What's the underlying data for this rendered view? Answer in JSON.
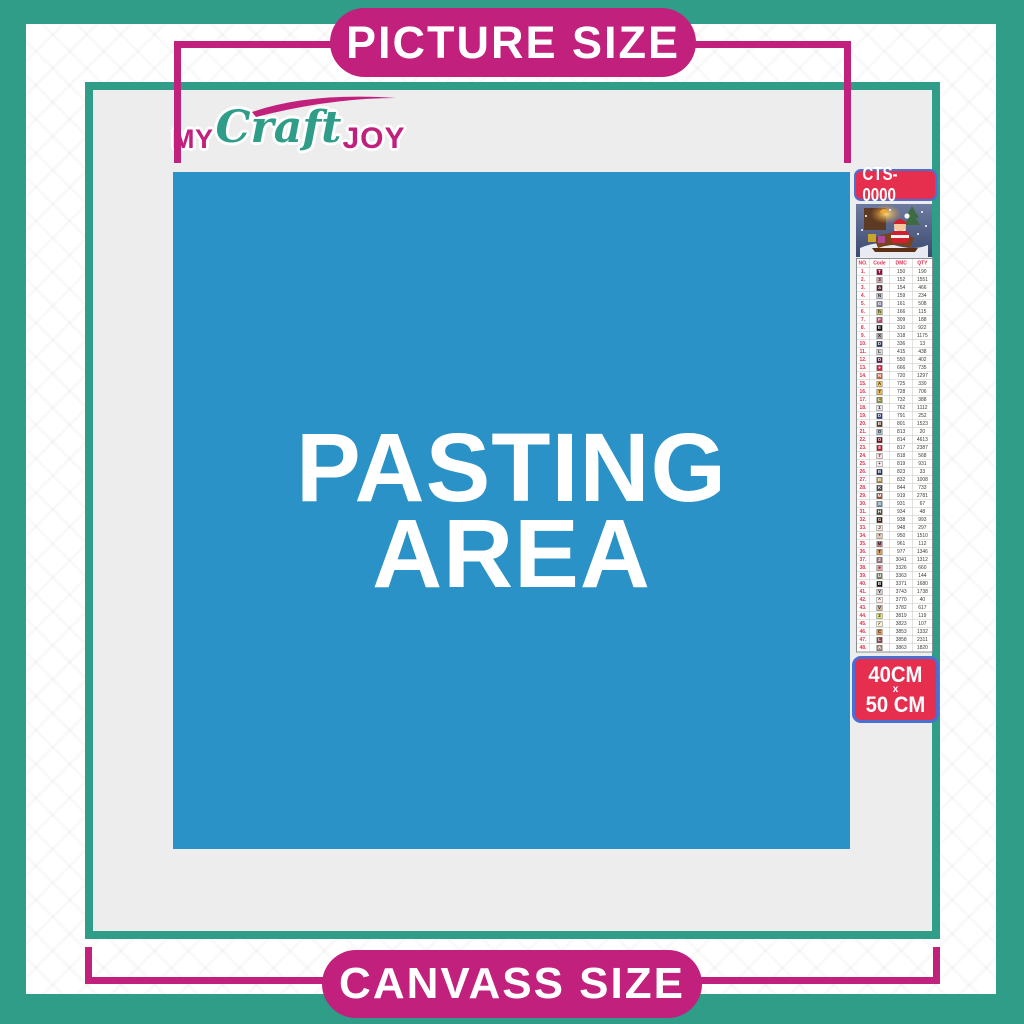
{
  "colors": {
    "teal": "#2f9d88",
    "magenta": "#c1217c",
    "blue": "#2b92c7",
    "red": "#e62e4e",
    "blue_border": "#4a6fd0",
    "interior_gray": "#ededee"
  },
  "banner_top": {
    "label": "PICTURE SIZE"
  },
  "banner_bottom": {
    "label": "CANVASS SIZE"
  },
  "logo": {
    "part1": "MY",
    "part2": "Craft",
    "part3": "JOY"
  },
  "pasting_area": {
    "line1": "PASTING",
    "line2": "AREA"
  },
  "product": {
    "code": "CTS-0000"
  },
  "size_badge": {
    "line1": "40CM",
    "sep": "x",
    "line2": "50 CM"
  },
  "thumbnail": {
    "description": "santa-claus-sleigh-christmas-scene"
  },
  "table": {
    "headers": [
      "NO.",
      "Code",
      "DMC",
      "QTY"
    ],
    "rows": [
      {
        "no": "1.",
        "symbol": "T",
        "chip": "#9b0a3c",
        "dmc": "150",
        "qty": "190"
      },
      {
        "no": "2.",
        "symbol": "3",
        "chip": "#dba6a9",
        "dmc": "152",
        "qty": "1551"
      },
      {
        "no": "3.",
        "symbol": "a",
        "chip": "#572433",
        "dmc": "154",
        "qty": "466"
      },
      {
        "no": "4.",
        "symbol": "N",
        "chip": "#c3c8d8",
        "dmc": "159",
        "qty": "234"
      },
      {
        "no": "5.",
        "symbol": "G",
        "chip": "#7880a4",
        "dmc": "161",
        "qty": "508"
      },
      {
        "no": "6.",
        "symbol": "h",
        "chip": "#c3c64c",
        "dmc": "166",
        "qty": "115"
      },
      {
        "no": "7.",
        "symbol": "F",
        "chip": "#c2426e",
        "dmc": "309",
        "qty": "188"
      },
      {
        "no": "8.",
        "symbol": "E",
        "chip": "#121212",
        "dmc": "310",
        "qty": "922"
      },
      {
        "no": "9.",
        "symbol": "X",
        "chip": "#a8a9ad",
        "dmc": "318",
        "qty": "1175"
      },
      {
        "no": "10.",
        "symbol": "D",
        "chip": "#1f3864",
        "dmc": "336",
        "qty": "13"
      },
      {
        "no": "11.",
        "symbol": "L",
        "chip": "#d6d7db",
        "dmc": "415",
        "qty": "438"
      },
      {
        "no": "12.",
        "symbol": "D",
        "chip": "#5c184e",
        "dmc": "550",
        "qty": "402"
      },
      {
        "no": "13.",
        "symbol": "●",
        "chip": "#e31d42",
        "dmc": "666",
        "qty": "735"
      },
      {
        "no": "14.",
        "symbol": "N",
        "chip": "#e25f2b",
        "dmc": "720",
        "qty": "1297"
      },
      {
        "no": "15.",
        "symbol": "A",
        "chip": "#ffc840",
        "dmc": "725",
        "qty": "330"
      },
      {
        "no": "16.",
        "symbol": "7",
        "chip": "#edb549",
        "dmc": "728",
        "qty": "706"
      },
      {
        "no": "17.",
        "symbol": "L",
        "chip": "#8f8f2e",
        "dmc": "732",
        "qty": "388"
      },
      {
        "no": "18.",
        "symbol": "1",
        "chip": "#e8e8ea",
        "dmc": "762",
        "qty": "1112"
      },
      {
        "no": "19.",
        "symbol": "D",
        "chip": "#2c3c8c",
        "dmc": "791",
        "qty": "252"
      },
      {
        "no": "20.",
        "symbol": "B",
        "chip": "#65350f",
        "dmc": "801",
        "qty": "1523"
      },
      {
        "no": "21.",
        "symbol": "O",
        "chip": "#a0c3de",
        "dmc": "813",
        "qty": "20"
      },
      {
        "no": "22.",
        "symbol": "O",
        "chip": "#7b001b",
        "dmc": "814",
        "qty": "4613"
      },
      {
        "no": "23.",
        "symbol": "8",
        "chip": "#cf1127",
        "dmc": "817",
        "qty": "2387"
      },
      {
        "no": "24.",
        "symbol": "7",
        "chip": "#ffdfe5",
        "dmc": "818",
        "qty": "568"
      },
      {
        "no": "25.",
        "symbol": "+",
        "chip": "#fdeef3",
        "dmc": "819",
        "qty": "931"
      },
      {
        "no": "26.",
        "symbol": "B",
        "chip": "#213063",
        "dmc": "823",
        "qty": "33"
      },
      {
        "no": "27.",
        "symbol": "B",
        "chip": "#b08b2c",
        "dmc": "832",
        "qty": "1008"
      },
      {
        "no": "28.",
        "symbol": "K",
        "chip": "#484848",
        "dmc": "844",
        "qty": "733"
      },
      {
        "no": "29.",
        "symbol": "M",
        "chip": "#a34a28",
        "dmc": "919",
        "qty": "2781"
      },
      {
        "no": "30.",
        "symbol": "S",
        "chip": "#6a8fab",
        "dmc": "931",
        "qty": "67"
      },
      {
        "no": "31.",
        "symbol": "H",
        "chip": "#4a4b36",
        "dmc": "934",
        "qty": "48"
      },
      {
        "no": "32.",
        "symbol": "G",
        "chip": "#451e0c",
        "dmc": "938",
        "qty": "993"
      },
      {
        "no": "33.",
        "symbol": "J",
        "chip": "#fde9da",
        "dmc": "948",
        "qty": "297"
      },
      {
        "no": "34.",
        "symbol": "*",
        "chip": "#e8c5ae",
        "dmc": "950",
        "qty": "1510"
      },
      {
        "no": "35.",
        "symbol": "M",
        "chip": "#cf7387",
        "dmc": "961",
        "qty": "112"
      },
      {
        "no": "36.",
        "symbol": "T",
        "chip": "#dc9c56",
        "dmc": "977",
        "qty": "1346"
      },
      {
        "no": "37.",
        "symbol": "2",
        "chip": "#956f7c",
        "dmc": "3041",
        "qty": "1312"
      },
      {
        "no": "38.",
        "symbol": "e",
        "chip": "#fba0ae",
        "dmc": "3326",
        "qty": "660"
      },
      {
        "no": "39.",
        "symbol": "U",
        "chip": "#728256",
        "dmc": "3363",
        "qty": "144"
      },
      {
        "no": "40.",
        "symbol": "B",
        "chip": "#1e1108",
        "dmc": "3371",
        "qty": "1680"
      },
      {
        "no": "41.",
        "symbol": "Y",
        "chip": "#d7cbd3",
        "dmc": "3743",
        "qty": "1738"
      },
      {
        "no": "42.",
        "symbol": "^",
        "chip": "#ffeee3",
        "dmc": "3770",
        "qty": "40"
      },
      {
        "no": "43.",
        "symbol": "V",
        "chip": "#d2bca6",
        "dmc": "3782",
        "qty": "617"
      },
      {
        "no": "44.",
        "symbol": "2",
        "chip": "#e0e868",
        "dmc": "3819",
        "qty": "119"
      },
      {
        "no": "45.",
        "symbol": "✓",
        "chip": "#fff3cf",
        "dmc": "3823",
        "qty": "107"
      },
      {
        "no": "46.",
        "symbol": "C",
        "chip": "#f29746",
        "dmc": "3853",
        "qty": "1332"
      },
      {
        "no": "47.",
        "symbol": "L",
        "chip": "#864545",
        "dmc": "3858",
        "qty": "2311"
      },
      {
        "no": "48.",
        "symbol": "A",
        "chip": "#a4846c",
        "dmc": "3863",
        "qty": "1820"
      }
    ]
  }
}
